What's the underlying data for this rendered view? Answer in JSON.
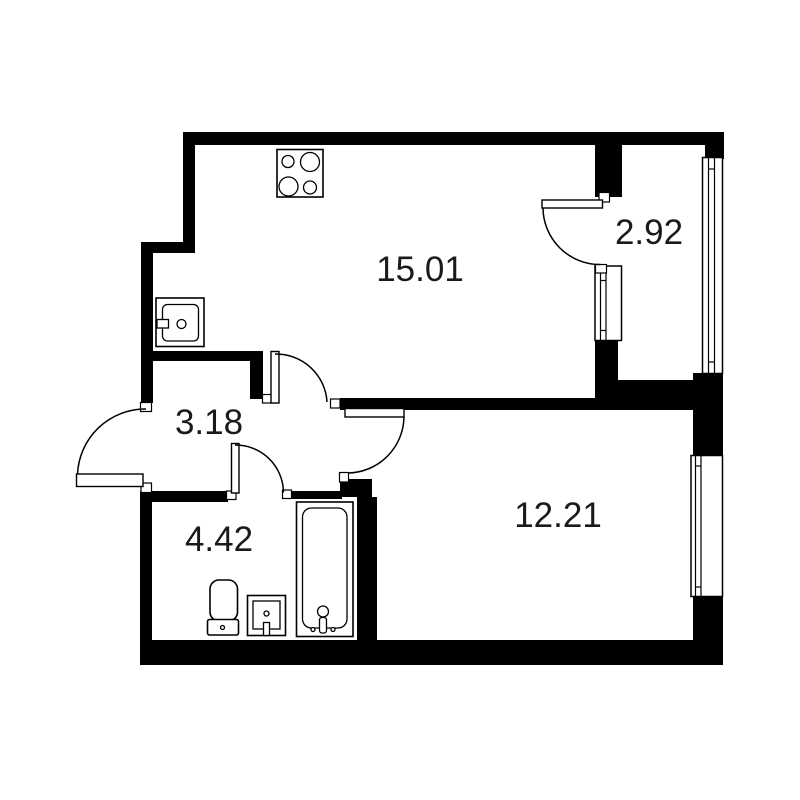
{
  "plan_title": "one-room-apartment-floor-plan",
  "colors": {
    "background": "#ffffff",
    "walls": "#000000",
    "lines": "#000000",
    "label_text": "#1a1a1a"
  },
  "rooms": [
    {
      "name": "kitchen-living-room",
      "area": "15.01"
    },
    {
      "name": "balcony",
      "area": "2.92"
    },
    {
      "name": "hallway",
      "area": "3.18"
    },
    {
      "name": "bathroom",
      "area": "4.42"
    },
    {
      "name": "bedroom",
      "area": "12.21"
    }
  ],
  "fixtures": [
    "stove",
    "kitchen-sink",
    "toilet",
    "washbasin",
    "bathtub"
  ],
  "doors": [
    "entrance-door",
    "living-room-door",
    "bedroom-door",
    "bathroom-door",
    "balcony-door"
  ],
  "windows": [
    "balcony-glazing",
    "balcony-block-window",
    "bedroom-window"
  ]
}
